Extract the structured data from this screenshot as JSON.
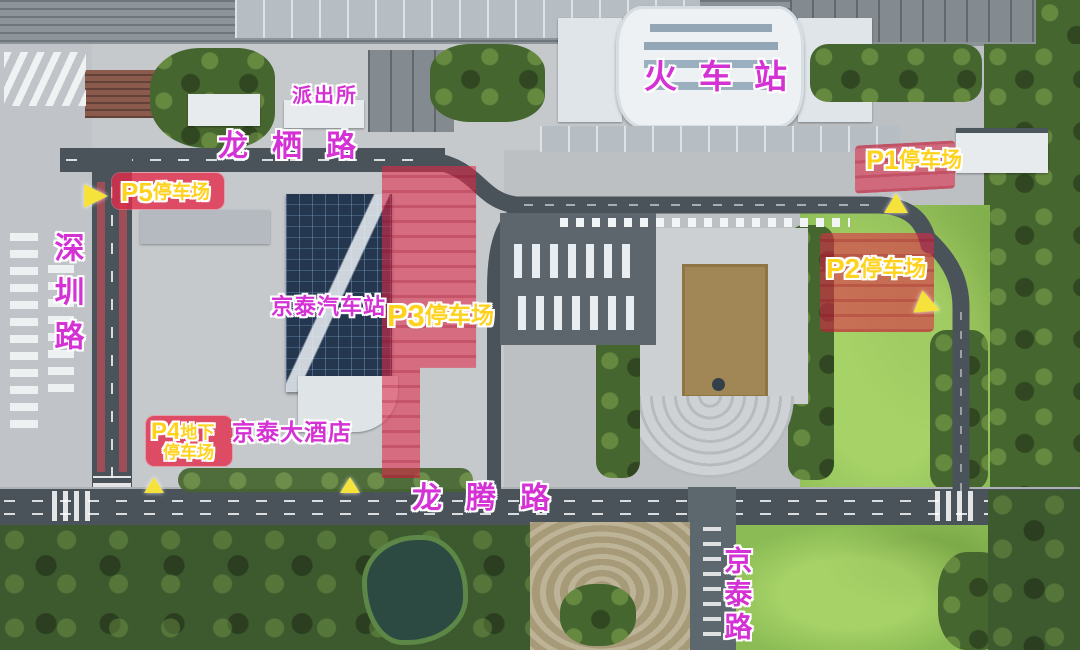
{
  "station": {
    "label": "火车站"
  },
  "roads": {
    "longqi": "龙栖路",
    "shenzhen": "深圳路",
    "longteng": "龙腾路",
    "jingtai": "京泰路"
  },
  "places": {
    "police": "派出所",
    "coach_station": "京泰汽车站",
    "hotel": "京泰大酒店"
  },
  "parking": {
    "p1": {
      "code": "P1",
      "name": "停车场"
    },
    "p2": {
      "code": "P2",
      "name": "停车场"
    },
    "p3": {
      "code": "P3",
      "name": "停车场"
    },
    "p4": {
      "code": "P4",
      "name": "地下",
      "name2": "停车场"
    },
    "p5": {
      "code": "P5",
      "name": "停车场"
    }
  },
  "markers": [
    {
      "at": "p5",
      "direction": "right"
    },
    {
      "at": "p1",
      "direction": "up"
    },
    {
      "at": "p2",
      "direction": "right"
    },
    {
      "at": "longteng-west",
      "direction": "up"
    },
    {
      "at": "longteng-mid",
      "direction": "up"
    }
  ],
  "colors": {
    "road_label": "#d432d4",
    "parking_label": "#ffd21e",
    "parking_highlight": "#e02a48",
    "marker": "#f5e33b"
  }
}
